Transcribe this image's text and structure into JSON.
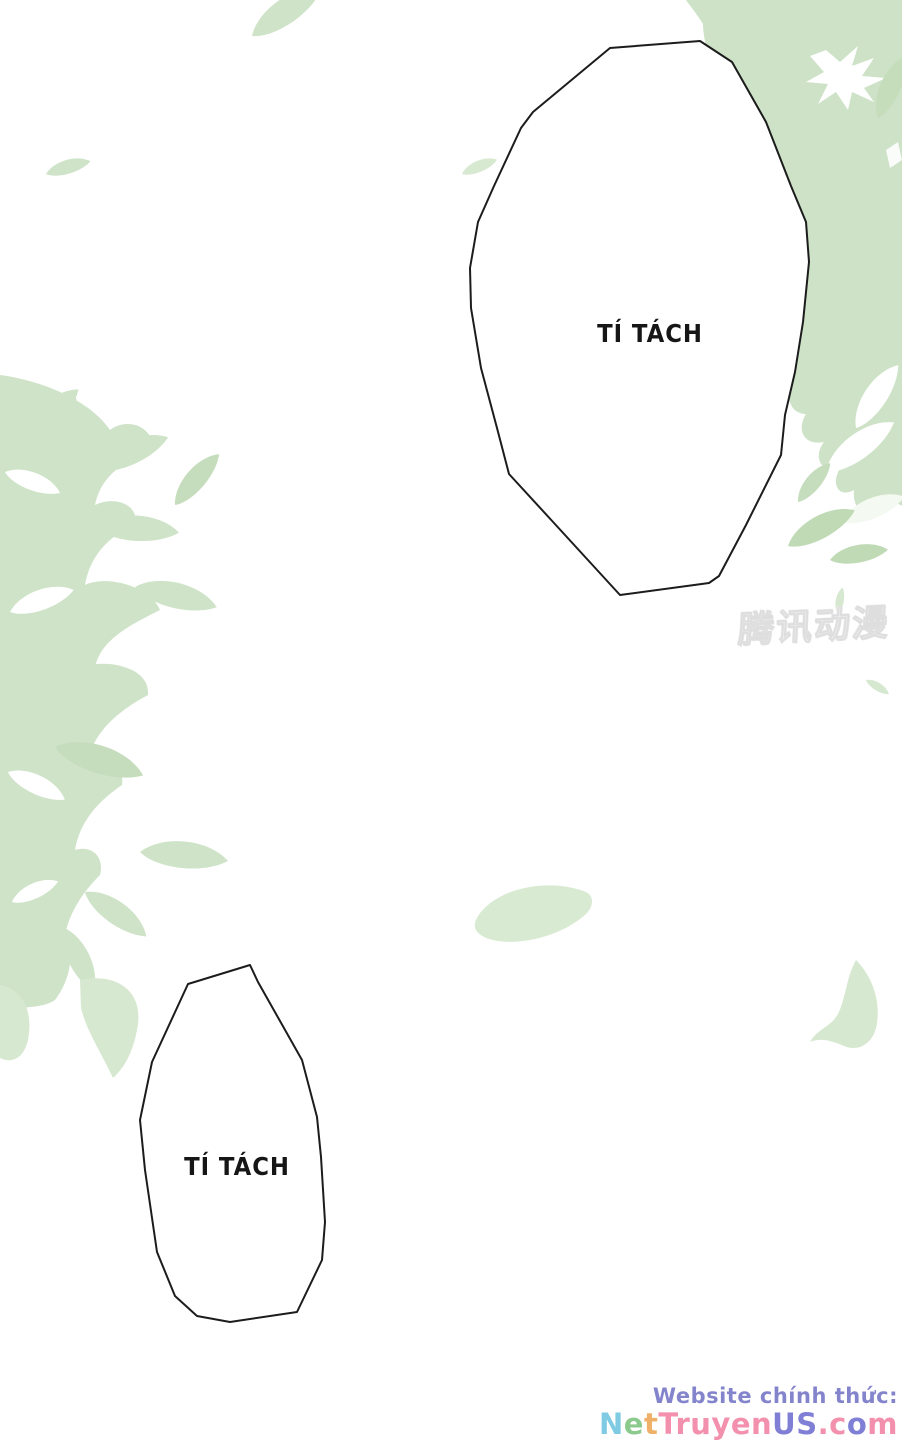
{
  "speech_bubbles": {
    "top": {
      "text": "TÍ TÁCH"
    },
    "bottom": {
      "text": "TÍ TÁCH"
    }
  },
  "watermark": {
    "text": "腾讯动漫"
  },
  "footer": {
    "line1": "Website chính thức:",
    "line1_style": "color:#8484cc",
    "site_letters": [
      {
        "ch": "N",
        "st": "color:#7ecbe3"
      },
      {
        "ch": "e",
        "st": "color:#8cc98c"
      },
      {
        "ch": "t",
        "st": "color:#efb169"
      },
      {
        "ch": "T",
        "st": "color:#f390ad"
      },
      {
        "ch": "r",
        "st": "color:#f390ad"
      },
      {
        "ch": "u",
        "st": "color:#f390ad"
      },
      {
        "ch": "y",
        "st": "color:#f390ad"
      },
      {
        "ch": "e",
        "st": "color:#f390ad"
      },
      {
        "ch": "n",
        "st": "color:#f390ad"
      },
      {
        "ch": "U",
        "st": "color:#7f7fd6"
      },
      {
        "ch": "S",
        "st": "color:#7f7fd6"
      },
      {
        "ch": ".",
        "st": "color:#f390ad"
      },
      {
        "ch": "c",
        "st": "color:#f390ad"
      },
      {
        "ch": "o",
        "st": "color:#7f7fd6"
      },
      {
        "ch": "m",
        "st": "color:#f390ad"
      }
    ]
  },
  "colors": {
    "page_background": "#ffffff",
    "leaf_mass_green": "#cde2c6",
    "leaf_green": "#cfe3c8",
    "leaf_green_dark": "#c0dab6",
    "leaf_green_faint": "#d9ead2",
    "bubble_outline": "#1c1c1c",
    "watermark_gray": "#e6e6e6"
  }
}
